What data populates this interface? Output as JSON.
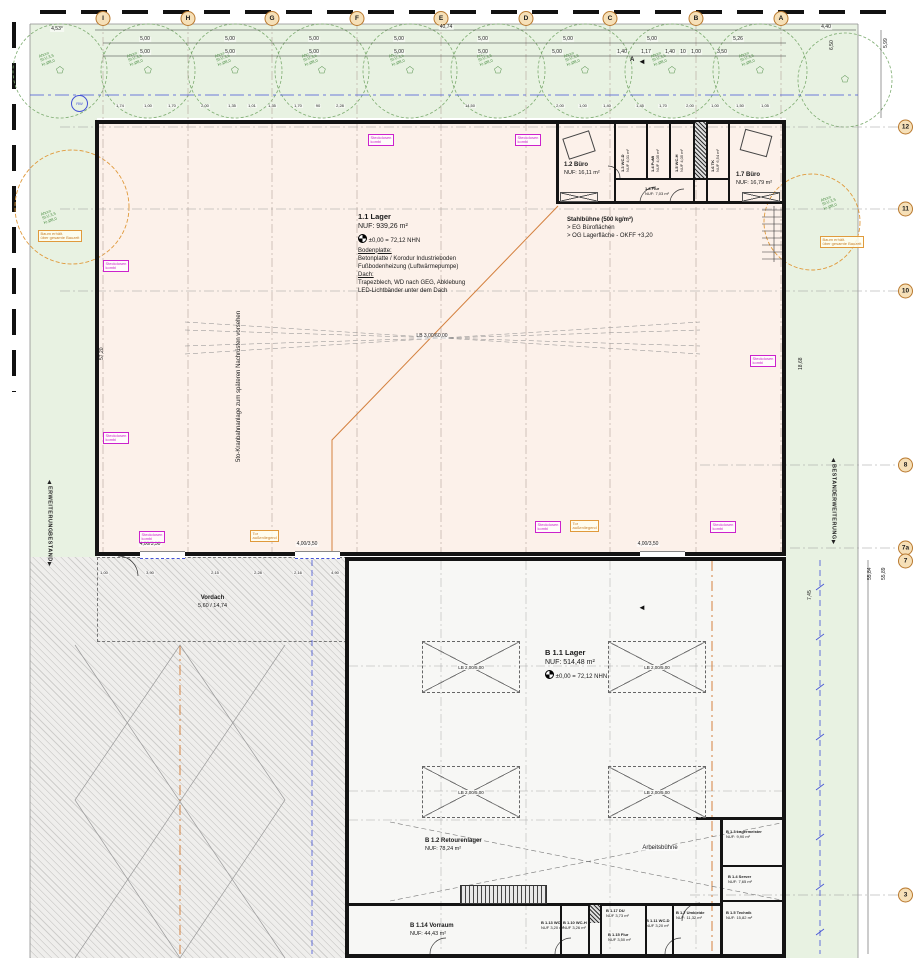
{
  "drawing_type": "Grundriss Erdgeschoss Lagerhalle (floor plan)",
  "axes_top": {
    "items": [
      {
        "label": "I",
        "x": 103
      },
      {
        "label": "H",
        "x": 188
      },
      {
        "label": "G",
        "x": 272
      },
      {
        "label": "F",
        "x": 357
      },
      {
        "label": "E",
        "x": 441
      },
      {
        "label": "D",
        "x": 526
      },
      {
        "label": "C",
        "x": 610
      },
      {
        "label": "B",
        "x": 696
      },
      {
        "label": "A",
        "x": 781
      }
    ]
  },
  "axes_right": {
    "items": [
      {
        "label": "12",
        "y": 127
      },
      {
        "label": "11",
        "y": 209
      },
      {
        "label": "10",
        "y": 291
      },
      {
        "label": "8",
        "y": 465
      },
      {
        "label": "7a",
        "y": 548
      },
      {
        "label": "7",
        "y": 561
      },
      {
        "label": "3",
        "y": 895
      }
    ]
  },
  "edge_markers": {
    "left_top": "ERWEITERUNG",
    "left_bottom": "BESTAND",
    "right_top": "BESTAND",
    "right_bottom": "ERWEITERUNG"
  },
  "hall": {
    "name": "1.1 Lager",
    "area": "NUF: 939,26 m²",
    "level": "±0,00 = 72,12 NHN",
    "sec1_title": "Bodenplatte:",
    "sec1_l1": "Betonplatte / Korodur Industrieboden",
    "sec1_l2": "Fußbodenheizung (Luftwärmepumpe)",
    "sec2_title": "Dach:",
    "sec2_l1": "Trapezblech, WD nach GEG, Abklebung",
    "sec2_l2": "LED-Lichtbänder unter dem Dach",
    "vertical_note": "5to-Kranbahnanlage zum späteren Nachrüsten vorsehen",
    "lb": "LB 3,00/60,00"
  },
  "stahlbuehne": {
    "l1": "Stahlbühne (500 kg/m²)",
    "l2": "> EG Büroflächen",
    "l3": "> OG Lagerfläche - OKFF +3,20"
  },
  "building_b": {
    "name": "B 1.1 Lager",
    "area": "NUF: 514,48 m²",
    "level": "±0,00 = 72,12 NHN",
    "lb": "LB 2,00/5,00",
    "lb_marks": [
      {
        "x": 422,
        "y": 641
      },
      {
        "x": 608,
        "y": 641
      },
      {
        "x": 422,
        "y": 766
      },
      {
        "x": 608,
        "y": 766
      }
    ],
    "arbeitsbuehne": "Arbeitsbühne"
  },
  "rooms": {
    "r12": {
      "name": "1.2 Büro",
      "area": "NUF: 16,11 m²"
    },
    "r13": {
      "name": "1.3 WC-D",
      "area": "NUF 4,01 m²"
    },
    "r14": {
      "name": "1.4 PuMi",
      "area": "NUF 4,05 m²"
    },
    "r15": {
      "name": "1.5 WC-H",
      "area": "NUF 4,05 m²"
    },
    "r16": {
      "name": "1.6 TK",
      "area": "NUF 6,54 m²"
    },
    "r17": {
      "name": "1.7 Büro",
      "area": "NUF: 16,79 m²"
    },
    "r18": {
      "name": "1.8 Flur",
      "area": "NUF: 7,03 m²"
    },
    "b12": {
      "name": "B 1.2 Retourenlager",
      "area": "NUF: 78,24 m²"
    },
    "b114": {
      "name": "B 1.14 Vorraum",
      "area": "NUF: 44,43 m²"
    },
    "b13": {
      "name": "B 1.3 Lagermeister",
      "area": "NUF: 9,90 m²"
    },
    "b14": {
      "name": "B 1.4 Server",
      "area": "NUF: 7,65 m²"
    },
    "b17": {
      "name": "B 1.7 Umkleide",
      "area": "NUF: 11,32 m²"
    },
    "b15": {
      "name": "B 1.5 Technik",
      "area": "NUF: 15,82 m²"
    },
    "b113": {
      "name": "B 1.13 WC",
      "area": "NUF 3,20 m²"
    },
    "b110": {
      "name": "B 1.10 WC-H",
      "area": "NUF 3,26 m²"
    },
    "b117": {
      "name": "B 1.17 DU",
      "area": "NUF 3,73 m²"
    },
    "b115": {
      "name": "B 1.15 Flur",
      "area": "NUF 3,50 m²"
    },
    "b111": {
      "name": "B 1.11 WC-D",
      "area": "NUF 3,20 m²"
    }
  },
  "vordach": {
    "l1": "Vordach",
    "l2": "5,60 / 14,74"
  },
  "gates": {
    "label": "4,00/3,50",
    "items": [
      {
        "x": 150,
        "y": 542
      },
      {
        "x": 307,
        "y": 542
      },
      {
        "x": 648,
        "y": 542
      }
    ]
  },
  "labels": {
    "steckdosen1": "Steckdosen",
    "steckdosen2": "kombi",
    "steck_items": [
      {
        "x": 368,
        "y": 134
      },
      {
        "x": 515,
        "y": 134
      },
      {
        "x": 103,
        "y": 260
      },
      {
        "x": 103,
        "y": 432
      },
      {
        "x": 750,
        "y": 355
      },
      {
        "x": 139,
        "y": 531
      },
      {
        "x": 535,
        "y": 521
      },
      {
        "x": 710,
        "y": 521
      }
    ],
    "tor_note1": "Tor",
    "tor_note2": "außenliegend",
    "tor_items": [
      {
        "x": 250,
        "y": 530
      },
      {
        "x": 570,
        "y": 520
      }
    ],
    "rw": "RW",
    "angle": "4,53°",
    "section": "A"
  },
  "trees": {
    "l1": "Ahorn",
    "l2": "St.U.3,5",
    "l3": "Kr.Ø8,0",
    "labels": [
      {
        "x": 40,
        "y": 52
      },
      {
        "x": 128,
        "y": 52
      },
      {
        "x": 216,
        "y": 52
      },
      {
        "x": 303,
        "y": 52
      },
      {
        "x": 390,
        "y": 52
      },
      {
        "x": 478,
        "y": 52
      },
      {
        "x": 565,
        "y": 52
      },
      {
        "x": 652,
        "y": 52
      },
      {
        "x": 740,
        "y": 52
      },
      {
        "x": 822,
        "y": 196
      },
      {
        "x": 42,
        "y": 210
      }
    ],
    "baum1": "Baum erhält.",
    "baum2": "über gesamte Bauzeit",
    "baum_items": [
      {
        "x": 38,
        "y": 230
      },
      {
        "x": 820,
        "y": 236
      }
    ]
  },
  "dims": {
    "total": "40,74",
    "right_end": "4,40",
    "row1": [
      {
        "t": "5,00",
        "x": 145
      },
      {
        "t": "5,00",
        "x": 230
      },
      {
        "t": "5,00",
        "x": 314
      },
      {
        "t": "5,00",
        "x": 399
      },
      {
        "t": "5,00",
        "x": 483
      },
      {
        "t": "5,00",
        "x": 568
      },
      {
        "t": "5,00",
        "x": 652
      },
      {
        "t": "5,26",
        "x": 738
      }
    ],
    "row2": [
      {
        "t": "5,00",
        "x": 145
      },
      {
        "t": "5,00",
        "x": 230
      },
      {
        "t": "5,00",
        "x": 314
      },
      {
        "t": "5,00",
        "x": 399
      },
      {
        "t": "5,00",
        "x": 483
      },
      {
        "t": "5,00",
        "x": 557
      },
      {
        "t": "1,40",
        "x": 622
      },
      {
        "t": "1,17",
        "x": 646
      },
      {
        "t": "1,40",
        "x": 670
      },
      {
        "t": "1,00",
        "x": 696
      },
      {
        "t": "10",
        "x": 683
      },
      {
        "t": "3,50",
        "x": 722
      }
    ],
    "small": [
      {
        "t": "1,74",
        "x": 120
      },
      {
        "t": "1,00",
        "x": 148
      },
      {
        "t": "1,70",
        "x": 172
      },
      {
        "t": "2,00",
        "x": 205
      },
      {
        "t": "1,35",
        "x": 232
      },
      {
        "t": "1,01",
        "x": 252
      },
      {
        "t": "1,35",
        "x": 272
      },
      {
        "t": "1,70",
        "x": 298
      },
      {
        "t": "90",
        "x": 318
      },
      {
        "t": "2,28",
        "x": 340
      },
      {
        "t": "14,50",
        "x": 470
      },
      {
        "t": "2,00",
        "x": 560
      },
      {
        "t": "1,00",
        "x": 583
      },
      {
        "t": "1,40",
        "x": 607
      },
      {
        "t": "1,45",
        "x": 640
      },
      {
        "t": "1,70",
        "x": 663
      },
      {
        "t": "2,00",
        "x": 690
      },
      {
        "t": "1,00",
        "x": 715
      },
      {
        "t": "1,50",
        "x": 740
      },
      {
        "t": "1,05",
        "x": 765
      }
    ],
    "bottom": [
      {
        "t": "1,00",
        "x": 104
      },
      {
        "t": "3,90",
        "x": 150
      },
      {
        "t": "2,15",
        "x": 215
      },
      {
        "t": "2,28",
        "x": 258
      },
      {
        "t": "2,16",
        "x": 298
      },
      {
        "t": "4,90",
        "x": 335
      }
    ],
    "vertical": [
      {
        "t": "5,99",
        "x": 884,
        "y": 48
      },
      {
        "t": "6,50",
        "x": 830,
        "y": 50
      },
      {
        "t": "18,68",
        "x": 799,
        "y": 370
      },
      {
        "t": "7,45",
        "x": 808,
        "y": 600
      },
      {
        "t": "55,84",
        "x": 868,
        "y": 580
      },
      {
        "t": "55,89",
        "x": 882,
        "y": 580
      },
      {
        "t": "57,20",
        "x": 100,
        "y": 360
      }
    ]
  }
}
